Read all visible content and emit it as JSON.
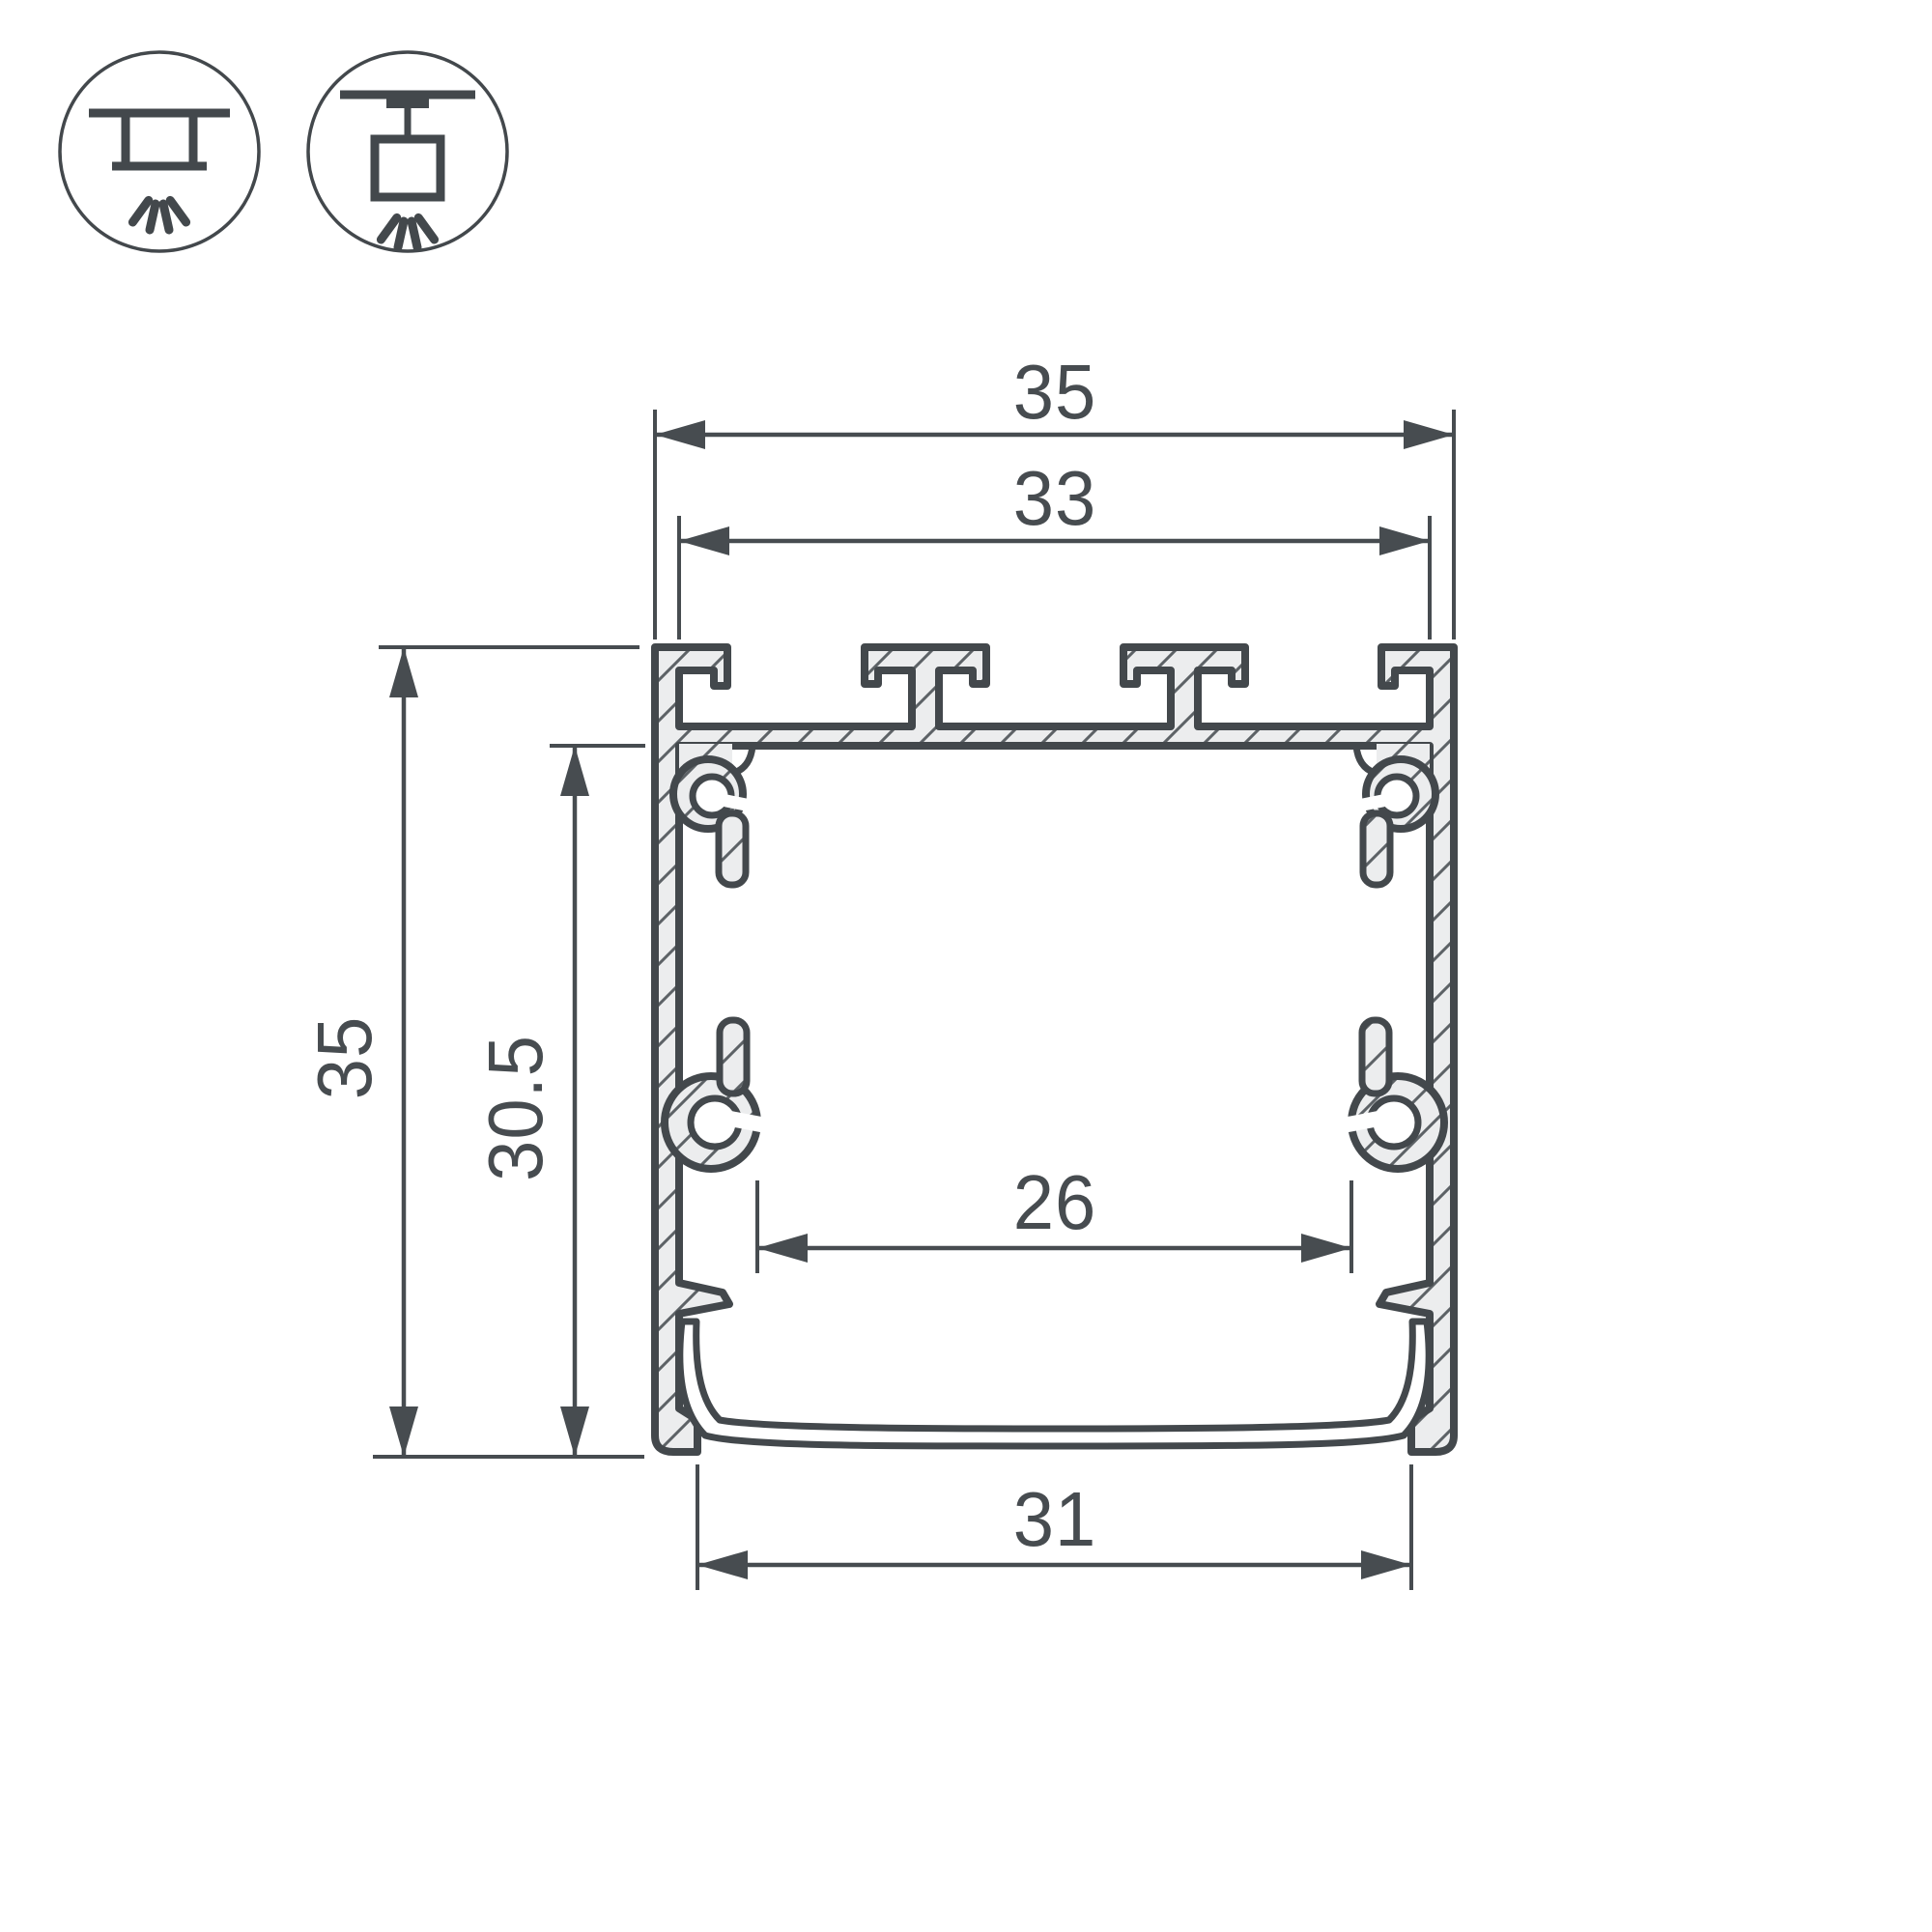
{
  "drawing": {
    "title": "LED profile cross-section dimensional drawing",
    "dimensions": {
      "outer_width": "35",
      "plate_width": "33",
      "outer_height": "35",
      "inner_height": "30.5",
      "inner_width": "26",
      "bottom_width": "31"
    },
    "mount_icons": [
      {
        "name": "recessed-ceiling-mount"
      },
      {
        "name": "surface-ceiling-mount"
      }
    ],
    "colors": {
      "line": "#43484c",
      "dimension": "#474c50",
      "metal_fill": "#ecedee",
      "hatch_line": "#5d6266",
      "background": "#ffffff"
    }
  }
}
